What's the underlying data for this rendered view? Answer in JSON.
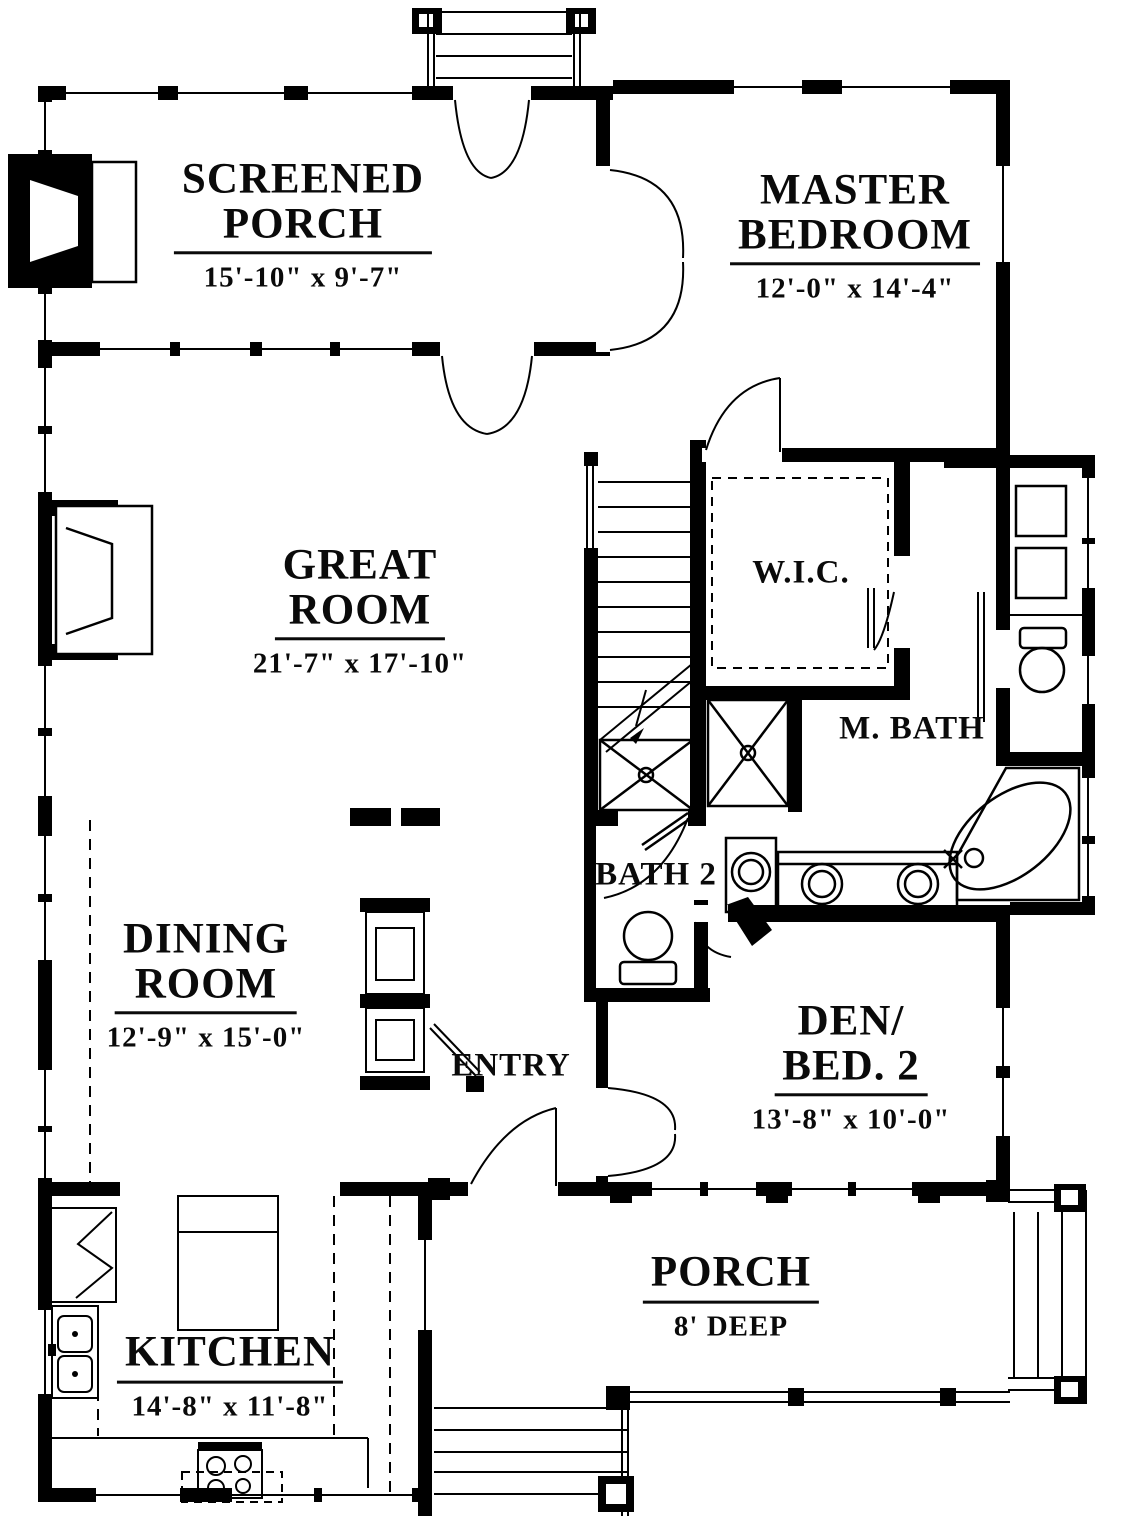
{
  "title": "First Floor Plan",
  "colors": {
    "ink": "#000000",
    "paper": "#ffffff"
  },
  "rooms": [
    {
      "id": "screened-porch",
      "name_lines": [
        "SCREENED",
        "PORCH"
      ],
      "dims": "15'-10\" x 9'-7\""
    },
    {
      "id": "master-bedroom",
      "name_lines": [
        "MASTER",
        "BEDROOM"
      ],
      "dims": "12'-0\" x 14'-4\""
    },
    {
      "id": "great-room",
      "name_lines": [
        "GREAT",
        "ROOM"
      ],
      "dims": "21'-7\" x 17'-10\""
    },
    {
      "id": "walk-in-closet",
      "label": "W.I.C."
    },
    {
      "id": "master-bath",
      "label": "M. BATH"
    },
    {
      "id": "bath-2",
      "label": "BATH 2"
    },
    {
      "id": "dining-room",
      "name_lines": [
        "DINING",
        "ROOM"
      ],
      "dims": "12'-9\" x 15'-0\""
    },
    {
      "id": "entry",
      "label": "ENTRY"
    },
    {
      "id": "den-bed-2",
      "name_lines": [
        "DEN/",
        "BED. 2"
      ],
      "dims": "13'-8\" x 10'-0\""
    },
    {
      "id": "kitchen",
      "name_lines": [
        "KITCHEN"
      ],
      "dims": "14'-8\" x 11'-8\""
    },
    {
      "id": "porch",
      "name_lines": [
        "PORCH"
      ],
      "dims": "8' DEEP"
    }
  ],
  "fixtures": [
    "fireplace",
    "fireplace",
    "stairs",
    "shower",
    "shower",
    "double-vanity",
    "corner-tub",
    "toilet",
    "toilet",
    "washer-dryer",
    "utility-sink",
    "refrigerator",
    "kitchen-sink",
    "range",
    "island",
    "entry-closet"
  ]
}
